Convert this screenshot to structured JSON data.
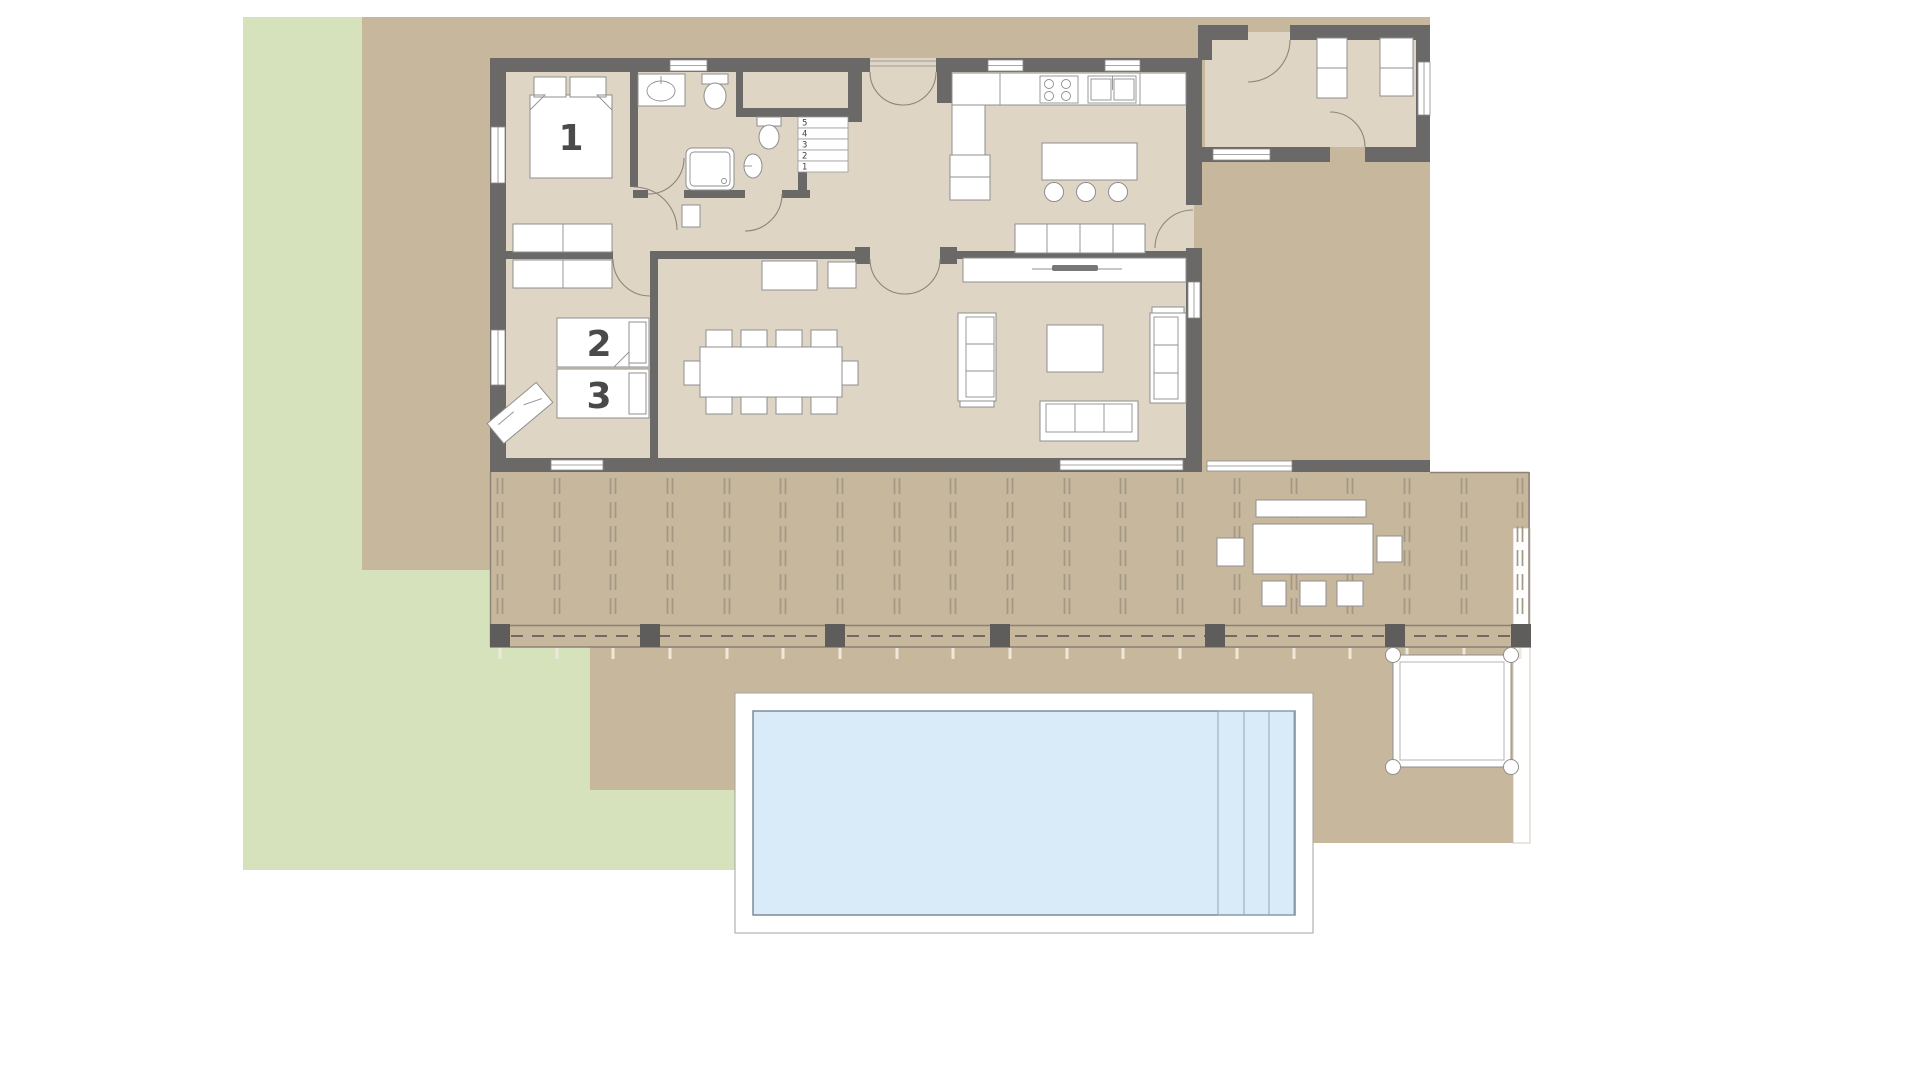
{
  "page_title": "House ground-floor plan with terrace and pool",
  "colors": {
    "lawn": "#d6e2bc",
    "ground": "#c7b79c",
    "floor": "#ded5c4",
    "wall": "#6a6967",
    "water": "#d9eaf8",
    "furniture_stroke": "#8f8f8f",
    "label": "#4a4a4a"
  },
  "rooms": {
    "bedroom1": {
      "label": "1",
      "furniture": [
        "double-bed",
        "pillows",
        "wardrobe"
      ]
    },
    "bedroom2": {
      "label": "2",
      "furniture": [
        "single-bed",
        "wardrobe",
        "desk"
      ]
    },
    "bedroom3": {
      "label": "3",
      "furniture": [
        "single-bed"
      ]
    },
    "bathroom": {
      "fixtures": [
        "washbasin",
        "toilet",
        "shower"
      ]
    },
    "wc": {
      "fixtures": [
        "toilet",
        "washbasin"
      ]
    },
    "kitchen": {
      "fixtures": [
        "counter",
        "cooktop",
        "double-sink",
        "fridge",
        "island",
        "bar-stools",
        "sideboard"
      ]
    },
    "dining": {
      "furniture": [
        "dining-table",
        "ten-chairs",
        "sideboard"
      ]
    },
    "living": {
      "furniture": [
        "tv-console",
        "tv",
        "sofa-left",
        "sofa-right",
        "sofa-bottom",
        "coffee-table"
      ]
    },
    "utility": {
      "furniture": [
        "cabinets"
      ]
    }
  },
  "stairs": {
    "steps": [
      "5",
      "4",
      "3",
      "2",
      "1"
    ]
  },
  "outdoor": {
    "terrace": "covered-terrace-with-joists-and-posts",
    "pool": "swimming-pool-with-steps",
    "pergola": "square-sun-deck",
    "dining_set": [
      "bench",
      "table",
      "three-chairs",
      "two-side-chairs"
    ]
  }
}
